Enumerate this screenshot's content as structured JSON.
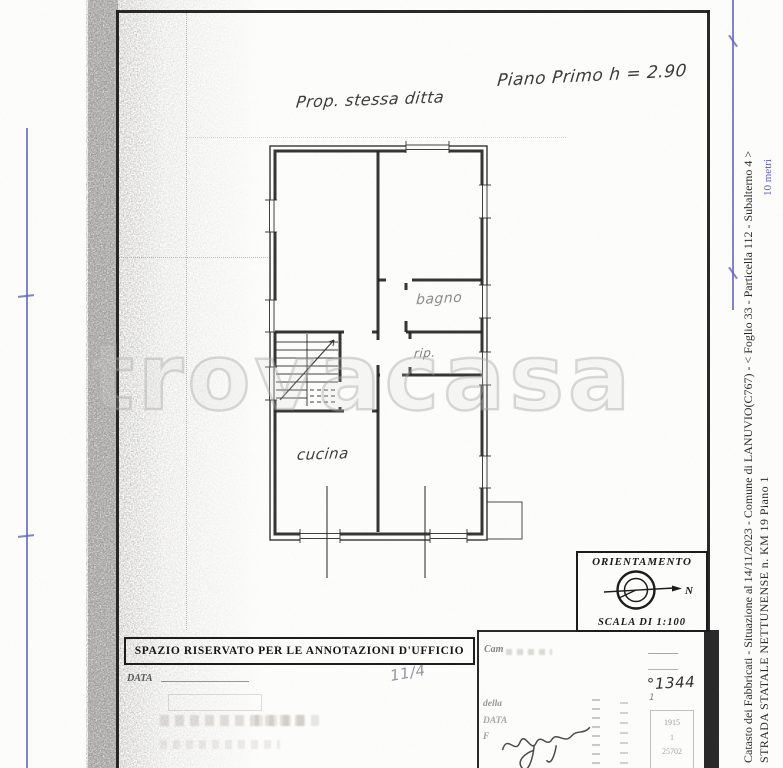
{
  "watermark": "trovacasa",
  "handwritten": {
    "property_note": "Prop. stessa ditta",
    "floor_note": "Piano Primo h = 2.90",
    "date_fraction": "11/4",
    "protocol_number": "°1344",
    "small_one": "1"
  },
  "plan": {
    "room_labels": {
      "bagno": "bagno",
      "rip": "rip.",
      "cucina": "cucina"
    }
  },
  "orientation": {
    "title": "ORIENTAMENTO",
    "north": "N",
    "scale": "SCALA DI 1:100"
  },
  "office_box": {
    "header": "SPAZIO RISERVATO PER LE ANNOTAZIONI D'UFFICIO",
    "data_label": "DATA"
  },
  "faded": {
    "cartella": "Cam",
    "della": "della",
    "data": "DATA",
    "firma": "F",
    "num1": "1915",
    "num2": "1",
    "num3": "25702"
  },
  "scale_bar_label": "10 metri",
  "margin": {
    "line1": "Catasto dei Fabbricati - Situazione al 14/11/2023 - Comune di LANUVIO(C767) - <  Foglio 33 - Particella 112 - Subalterno 4 >",
    "line2": "STRADA STATALE NETTUNENSE n. KM 19 Piano 1"
  },
  "colors": {
    "accent_blue": "#6064be",
    "ink": "#1d1d1d",
    "paper": "#fcfcfa"
  }
}
